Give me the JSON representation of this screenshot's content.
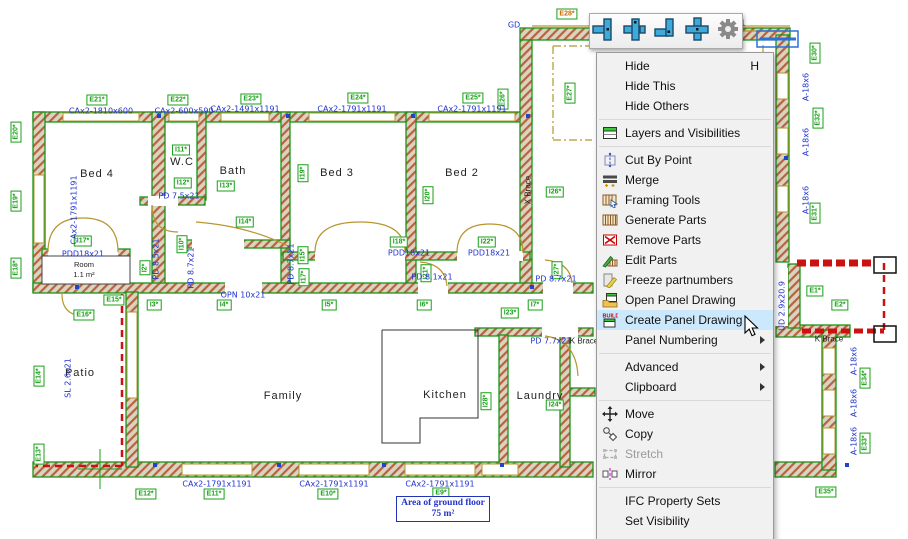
{
  "toolbar": {
    "icons": [
      {
        "name": "wall-junction-t-right-icon"
      },
      {
        "name": "wall-junction-cross-offset-icon"
      },
      {
        "name": "wall-junction-corner-icon"
      },
      {
        "name": "wall-junction-cross-icon"
      },
      {
        "name": "settings-gear-icon"
      }
    ]
  },
  "context_menu": {
    "items": [
      {
        "label": "Hide",
        "shortcut": "H"
      },
      {
        "label": "Hide This"
      },
      {
        "label": "Hide Others"
      },
      {
        "type": "separator"
      },
      {
        "label": "Layers and Visibilities",
        "icon": "layers"
      },
      {
        "type": "separator"
      },
      {
        "label": "Cut By Point",
        "icon": "cut"
      },
      {
        "label": "Merge",
        "icon": "merge"
      },
      {
        "label": "Framing Tools",
        "icon": "framing"
      },
      {
        "label": "Generate Parts",
        "icon": "generate"
      },
      {
        "label": "Remove Parts",
        "icon": "remove"
      },
      {
        "label": "Edit Parts",
        "icon": "edit"
      },
      {
        "label": "Freeze partnumbers",
        "icon": "freeze"
      },
      {
        "label": "Open Panel Drawing",
        "icon": "openpanel"
      },
      {
        "label": "Create Panel Drawing",
        "icon": "createpanel",
        "highlighted": true
      },
      {
        "label": "Panel Numbering",
        "submenu": true
      },
      {
        "type": "separator"
      },
      {
        "label": "Advanced",
        "submenu": true
      },
      {
        "label": "Clipboard",
        "submenu": true
      },
      {
        "type": "separator"
      },
      {
        "label": "Move",
        "icon": "move"
      },
      {
        "label": "Copy",
        "icon": "copy"
      },
      {
        "label": "Stretch",
        "icon": "stretch",
        "disabled": true
      },
      {
        "label": "Mirror",
        "icon": "mirror"
      },
      {
        "type": "separator"
      },
      {
        "label": "IFC Property Sets"
      },
      {
        "label": "Set Visibility"
      }
    ]
  },
  "plan": {
    "rooms": [
      {
        "name": "Bed 4",
        "x": 97,
        "y": 174
      },
      {
        "name": "W.C",
        "x": 182,
        "y": 162
      },
      {
        "name": "Bath",
        "x": 233,
        "y": 171
      },
      {
        "name": "Bed 3",
        "x": 337,
        "y": 173
      },
      {
        "name": "Bed 2",
        "x": 462,
        "y": 173
      },
      {
        "name": "Patio",
        "x": 80,
        "y": 373
      },
      {
        "name": "Family",
        "x": 283,
        "y": 396
      },
      {
        "name": "Kitchen",
        "x": 445,
        "y": 395
      },
      {
        "name": "Laundry",
        "x": 540,
        "y": 396
      }
    ],
    "room_small": {
      "name": "Room",
      "area": "1.1 m²",
      "x": 84,
      "y": 270
    },
    "area_box": {
      "line1": "Area of ground floor",
      "line2": "75 m²"
    },
    "tags": [
      {
        "t": "E21*",
        "x": 97,
        "y": 100
      },
      {
        "t": "E22*",
        "x": 178,
        "y": 100
      },
      {
        "t": "E23*",
        "x": 251,
        "y": 99
      },
      {
        "t": "E24*",
        "x": 358,
        "y": 98
      },
      {
        "t": "E25*",
        "x": 473,
        "y": 98
      },
      {
        "t": "E26*",
        "x": 503,
        "y": 99,
        "r": 1
      },
      {
        "t": "E27*",
        "x": 570,
        "y": 93,
        "r": 1
      },
      {
        "t": "E28*",
        "x": 567,
        "y": 14,
        "sel": 1
      },
      {
        "t": "E20*",
        "x": 16,
        "y": 132,
        "r": 1
      },
      {
        "t": "E19*",
        "x": 16,
        "y": 201,
        "r": 1
      },
      {
        "t": "E18*",
        "x": 16,
        "y": 268,
        "r": 1
      },
      {
        "t": "E16*",
        "x": 84,
        "y": 315
      },
      {
        "t": "E15*",
        "x": 114,
        "y": 300
      },
      {
        "t": "E14*",
        "x": 39,
        "y": 376,
        "r": 1
      },
      {
        "t": "E13*",
        "x": 39,
        "y": 454,
        "r": 1
      },
      {
        "t": "E12*",
        "x": 146,
        "y": 494
      },
      {
        "t": "E11*",
        "x": 214,
        "y": 494
      },
      {
        "t": "E10*",
        "x": 328,
        "y": 494
      },
      {
        "t": "E9*",
        "x": 441,
        "y": 493
      },
      {
        "t": "E30*",
        "x": 815,
        "y": 53,
        "r": 1
      },
      {
        "t": "E32*",
        "x": 818,
        "y": 118,
        "r": 1
      },
      {
        "t": "E31*",
        "x": 815,
        "y": 213,
        "r": 1
      },
      {
        "t": "E1*",
        "x": 815,
        "y": 291
      },
      {
        "t": "E2*",
        "x": 840,
        "y": 305
      },
      {
        "t": "E34*",
        "x": 865,
        "y": 378,
        "r": 1
      },
      {
        "t": "E33*",
        "x": 865,
        "y": 443,
        "r": 1
      },
      {
        "t": "E35*",
        "x": 826,
        "y": 492
      },
      {
        "t": "I11*",
        "x": 181,
        "y": 150
      },
      {
        "t": "I12*",
        "x": 183,
        "y": 183
      },
      {
        "t": "I13*",
        "x": 226,
        "y": 186
      },
      {
        "t": "I14*",
        "x": 245,
        "y": 222
      },
      {
        "t": "I10*",
        "x": 182,
        "y": 244,
        "r": 1
      },
      {
        "t": "I2*",
        "x": 145,
        "y": 268,
        "r": 1
      },
      {
        "t": "I19*",
        "x": 303,
        "y": 173,
        "r": 1
      },
      {
        "t": "I15*",
        "x": 303,
        "y": 255,
        "r": 1
      },
      {
        "t": "I17*",
        "x": 304,
        "y": 277,
        "r": 1
      },
      {
        "t": "I17*",
        "x": 83,
        "y": 241
      },
      {
        "t": "I18*",
        "x": 399,
        "y": 242
      },
      {
        "t": "I20*",
        "x": 428,
        "y": 195,
        "r": 1
      },
      {
        "t": "I21*",
        "x": 426,
        "y": 273,
        "r": 1
      },
      {
        "t": "I22*",
        "x": 487,
        "y": 242
      },
      {
        "t": "I26*",
        "x": 555,
        "y": 192
      },
      {
        "t": "I27*",
        "x": 557,
        "y": 270,
        "r": 1
      },
      {
        "t": "I3*",
        "x": 154,
        "y": 305
      },
      {
        "t": "I4*",
        "x": 224,
        "y": 305
      },
      {
        "t": "I5*",
        "x": 329,
        "y": 305
      },
      {
        "t": "I6*",
        "x": 424,
        "y": 305
      },
      {
        "t": "I23*",
        "x": 510,
        "y": 313
      },
      {
        "t": "I7*",
        "x": 535,
        "y": 305
      },
      {
        "t": "I28*",
        "x": 486,
        "y": 401,
        "r": 1
      },
      {
        "t": "I24*",
        "x": 555,
        "y": 405
      }
    ],
    "blue_labels": [
      {
        "t": "CAx2-1810x600",
        "x": 101,
        "y": 111
      },
      {
        "t": "CAx2-600x590",
        "x": 184,
        "y": 111
      },
      {
        "t": "CAx2-1491x1191",
        "x": 245,
        "y": 109
      },
      {
        "t": "CAx2-1791x1191",
        "x": 352,
        "y": 109
      },
      {
        "t": "CAx2-1791x1191",
        "x": 472,
        "y": 109
      },
      {
        "t": "CAx2-1791x1191",
        "x": 74,
        "y": 210,
        "r": 1
      },
      {
        "t": "CAx2-1791x1191",
        "x": 217,
        "y": 484
      },
      {
        "t": "CAx2-1791x1191",
        "x": 334,
        "y": 484
      },
      {
        "t": "CAx2-1791x1191",
        "x": 440,
        "y": 484
      },
      {
        "t": "PDD18x21",
        "x": 83,
        "y": 254
      },
      {
        "t": "PD 7.5x21",
        "x": 179,
        "y": 196
      },
      {
        "t": "PD 8.5x21",
        "x": 156,
        "y": 259,
        "r": 1
      },
      {
        "t": "PD 8.7x21",
        "x": 191,
        "y": 268,
        "r": 1
      },
      {
        "t": "PD 8.7x21",
        "x": 291,
        "y": 264,
        "r": 1
      },
      {
        "t": "OPN 10x21",
        "x": 243,
        "y": 295
      },
      {
        "t": "PDD18x21",
        "x": 409,
        "y": 253
      },
      {
        "t": "PD 8.1x21",
        "x": 432,
        "y": 277
      },
      {
        "t": "PDD18x21",
        "x": 489,
        "y": 253
      },
      {
        "t": "PD 8.7x21",
        "x": 556,
        "y": 279
      },
      {
        "t": "PD 7.7x21",
        "x": 551,
        "y": 341
      },
      {
        "t": "SL 2.6x21",
        "x": 68,
        "y": 378,
        "r": 1
      },
      {
        "t": "A-18x6",
        "x": 806,
        "y": 87,
        "r": 1
      },
      {
        "t": "A-18x6",
        "x": 806,
        "y": 142,
        "r": 1
      },
      {
        "t": "A-18x6",
        "x": 806,
        "y": 200,
        "r": 1
      },
      {
        "t": "A-18x6",
        "x": 854,
        "y": 361,
        "r": 1
      },
      {
        "t": "A-18x6",
        "x": 854,
        "y": 403,
        "r": 1
      },
      {
        "t": "A-18x6",
        "x": 854,
        "y": 441,
        "r": 1
      },
      {
        "t": "UD 2.9x20.9",
        "x": 782,
        "y": 306,
        "r": 1
      },
      {
        "t": "GD",
        "x": 514,
        "y": 25
      },
      {
        "t": "x21",
        "x": 738,
        "y": 23
      }
    ],
    "black_labels": [
      {
        "t": "X Brace",
        "x": 528,
        "y": 190,
        "r": 1
      },
      {
        "t": "K Brace",
        "x": 829,
        "y": 339
      },
      {
        "t": "K Brace",
        "x": 584,
        "y": 341
      }
    ]
  }
}
